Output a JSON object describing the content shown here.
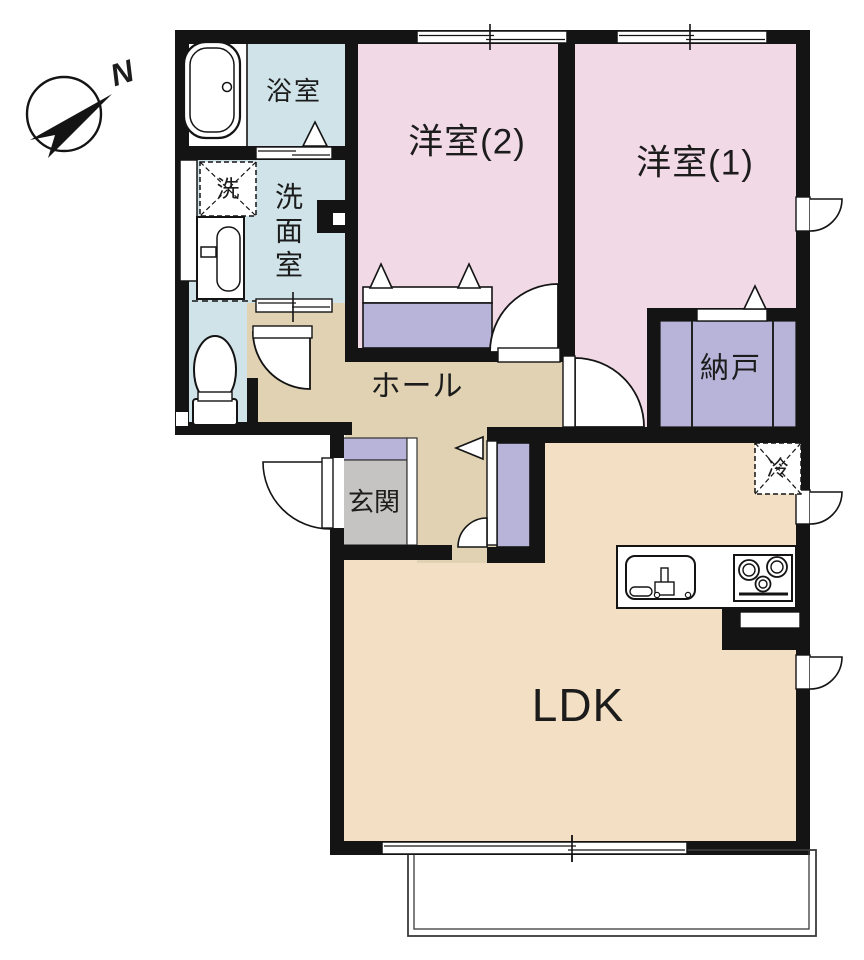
{
  "plan": {
    "type": "floorplan",
    "compass": {
      "label": "N"
    },
    "rooms": {
      "bath": {
        "label": "浴室",
        "color": "#cfe3e9"
      },
      "laundry": {
        "label": "洗",
        "color": "#ffffff"
      },
      "washroom": {
        "label": "洗面室",
        "color": "#cfe3e9"
      },
      "toilet": {
        "label": "",
        "color": "#cfe3e9"
      },
      "hall": {
        "label": "ホール",
        "color": "#e0d2b3"
      },
      "genkan": {
        "label": "玄関",
        "color": "#c6c4c2",
        "step_color": "#b7b3d9"
      },
      "western2": {
        "label": "洋室(2)",
        "color": "#f2d9e6"
      },
      "western1": {
        "label": "洋室(1)",
        "color": "#f2d9e6"
      },
      "nando": {
        "label": "納戸",
        "color": "#b7b3d9"
      },
      "fridge": {
        "label": "冷",
        "color": "#ffffff"
      },
      "ldk": {
        "label": "LDK",
        "color": "#f3dfc3"
      }
    },
    "wall_color": "#141414",
    "fixtures": [
      "bathtub",
      "vanity-sink",
      "washing-machine-space",
      "toilet",
      "kitchen-sink",
      "stove",
      "refrigerator-space",
      "balcony",
      "compass"
    ]
  }
}
